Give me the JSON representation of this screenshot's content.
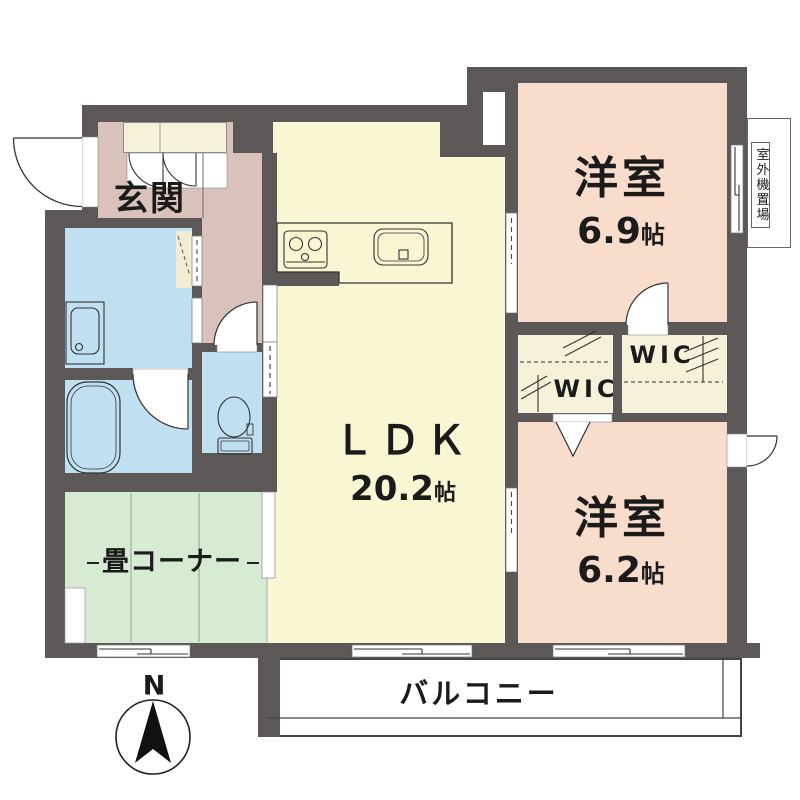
{
  "plan_title": "apartment-floor-plan",
  "palette": {
    "wall": "#5b5857",
    "entrance_floor": "#d8c2bb",
    "ldk_floor": "#f8f6d3",
    "bedroom_floor": "#f8ddcd",
    "wet_area_floor": "#c0dff1",
    "tatami_floor": "#d7ebd2",
    "closet_floor": "#f6f2d9",
    "line": "#333333"
  },
  "rooms": {
    "genkan": {
      "label": "玄関"
    },
    "ldk": {
      "name": "ＬＤＫ",
      "size_num": "20.2",
      "size_unit": "帖"
    },
    "bedroom1": {
      "name": "洋室",
      "size_num": "6.9",
      "size_unit": "帖"
    },
    "bedroom2": {
      "name": "洋室",
      "size_num": "6.2",
      "size_unit": "帖"
    },
    "wic_left": {
      "label": "WIC"
    },
    "wic_right": {
      "label": "WIC"
    },
    "tatami": {
      "label": "畳コーナー"
    },
    "balcony": {
      "label": "バルコニー"
    },
    "outdoor_unit": {
      "label": "室外機置場"
    }
  },
  "compass": {
    "north_label": "N"
  }
}
